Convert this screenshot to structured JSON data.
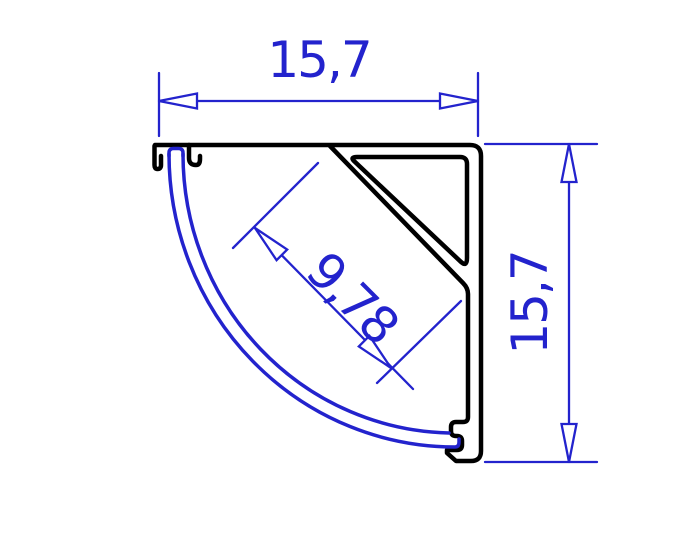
{
  "drawing": {
    "type": "technical-cross-section",
    "subject": "corner-profile-with-round-diffuser"
  },
  "dimensions": {
    "width": {
      "label": "15,7"
    },
    "height": {
      "label": "15,7"
    },
    "led_face": {
      "label": "9,78"
    }
  },
  "colors": {
    "blue": "#2323cd",
    "black": "#000000",
    "background": "#ffffff",
    "arrow_fill": "#ffffff"
  }
}
